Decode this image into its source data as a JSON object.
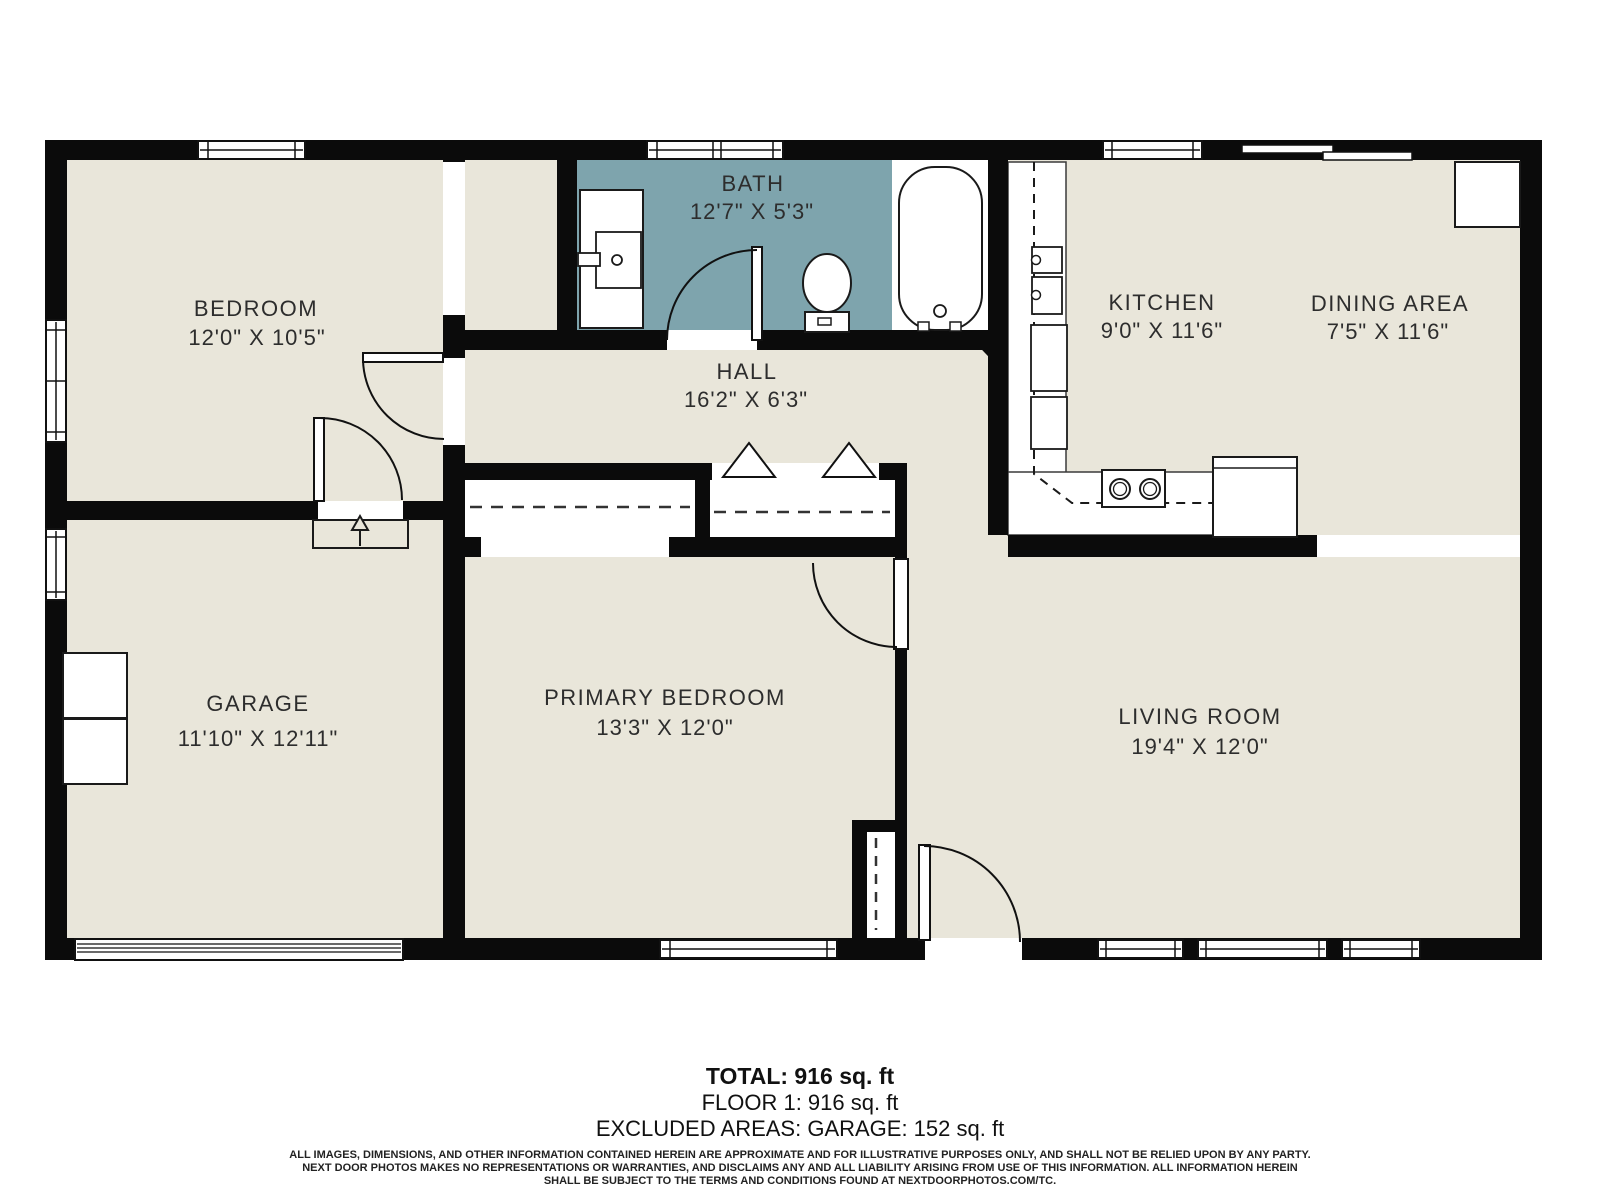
{
  "rooms": {
    "bedroom": {
      "name": "BEDROOM",
      "dims": "12'0\" X 10'5\""
    },
    "bath": {
      "name": "BATH",
      "dims": "12'7\" X 5'3\""
    },
    "hall": {
      "name": "HALL",
      "dims": "16'2\" X 6'3\""
    },
    "kitchen": {
      "name": "KITCHEN",
      "dims": "9'0\" X 11'6\""
    },
    "dining": {
      "name": "DINING AREA",
      "dims": "7'5\" X 11'6\""
    },
    "garage": {
      "name": "GARAGE",
      "dims": "11'10\" X 12'11\""
    },
    "primary": {
      "name": "PRIMARY BEDROOM",
      "dims": "13'3\" X 12'0\""
    },
    "living": {
      "name": "LIVING ROOM",
      "dims": "19'4\" X 12'0\""
    }
  },
  "summary": {
    "total": "TOTAL: 916 sq. ft",
    "floor": "FLOOR 1: 916 sq. ft",
    "excluded": "EXCLUDED AREAS: GARAGE: 152 sq. ft"
  },
  "disclaimer": {
    "line1": "ALL IMAGES, DIMENSIONS, AND OTHER INFORMATION CONTAINED HEREIN ARE APPROXIMATE AND FOR ILLUSTRATIVE PURPOSES ONLY, AND SHALL NOT BE RELIED UPON BY ANY PARTY.",
    "line2": "NEXT DOOR PHOTOS MAKES NO REPRESENTATIONS OR WARRANTIES, AND DISCLAIMS ANY AND ALL LIABILITY ARISING FROM USE OF THIS INFORMATION. ALL INFORMATION HEREIN",
    "line3": "SHALL BE SUBJECT TO THE TERMS AND CONDITIONS FOUND AT NEXTDOORPHOTOS.COM/TC."
  },
  "colors": {
    "floor": "#E9E6DA",
    "bath_accent": "#7EA4AD",
    "wall": "#0B0B0B"
  },
  "icons": {
    "step_arrow": "up-arrow"
  }
}
